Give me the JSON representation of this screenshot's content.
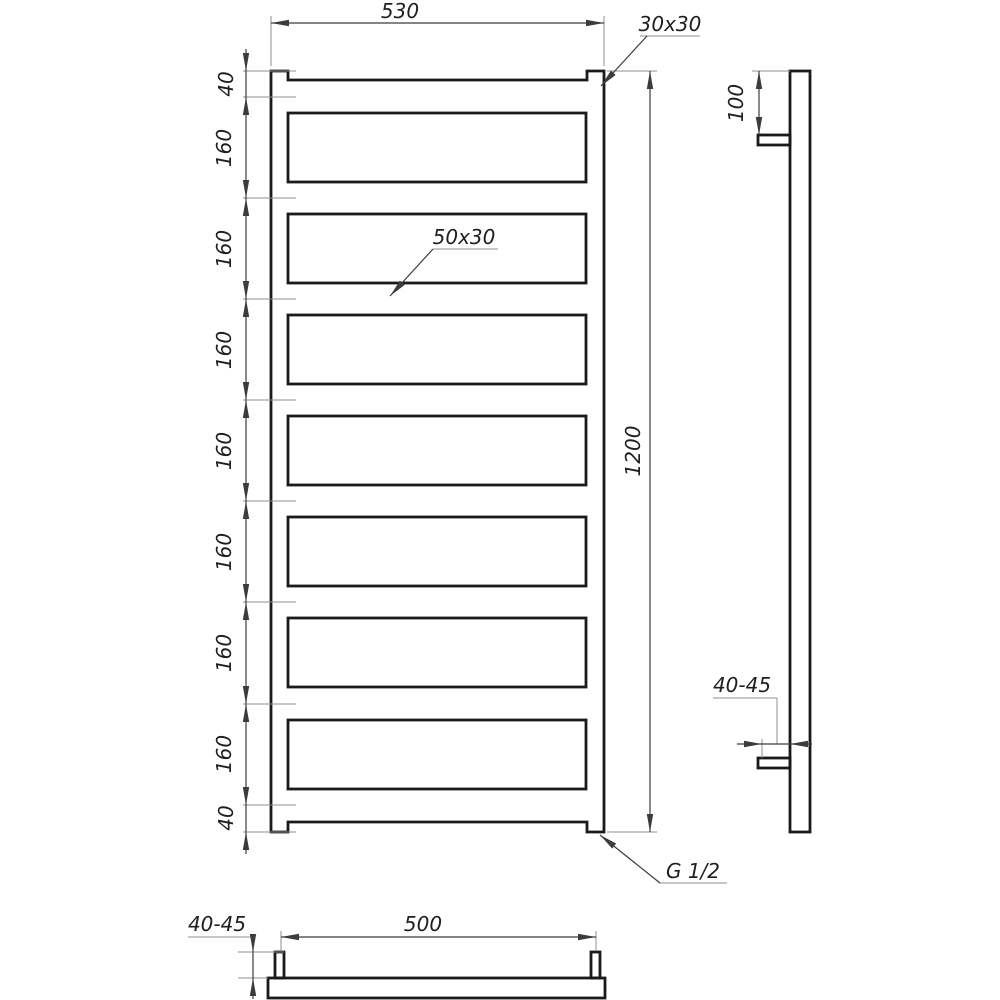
{
  "labels": {
    "front_view": {
      "overall_width": "530",
      "rail_profile": "30x30",
      "overall_height": "1200",
      "rung_profile": "50x30",
      "thread_size": "G 1/2",
      "segment_chain": [
        "40",
        "160",
        "160",
        "160",
        "160",
        "160",
        "160",
        "160",
        "40"
      ]
    },
    "side_view": {
      "top_bracket_offset": "100",
      "wall_clearance": "40-45"
    },
    "bottom_view": {
      "bracket_spacing": "500",
      "wall_clearance": "40-45"
    }
  },
  "colors": {
    "background": "#ffffff",
    "outline": "#1a1a1a",
    "dimension_line": "#3c3c3c",
    "extension_line": "#8f8f8f",
    "text": "#1f1f1f"
  }
}
